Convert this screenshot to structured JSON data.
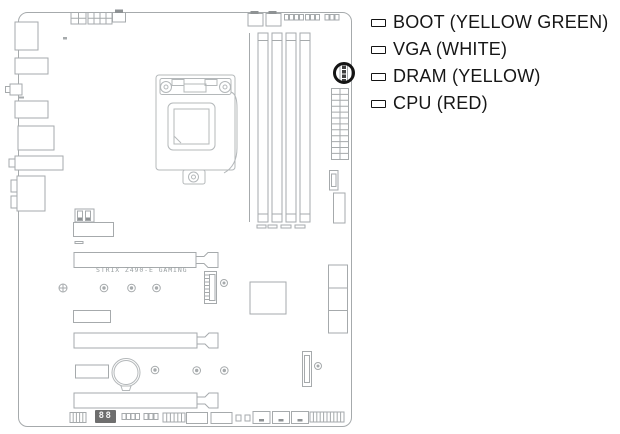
{
  "figure": {
    "type": "motherboard-qled-location-diagram",
    "highlight": "q-led-cluster-circled"
  },
  "legend": {
    "items": [
      {
        "id": "boot",
        "label": "BOOT (YELLOW GREEN)"
      },
      {
        "id": "vga",
        "label": "VGA (WHITE)"
      },
      {
        "id": "dram",
        "label": "DRAM (YELLOW)"
      },
      {
        "id": "cpu",
        "label": "CPU (RED)"
      }
    ]
  },
  "board": {
    "model_text": "STRIX Z490-E GAMING",
    "qcode_display": "88"
  },
  "icons": {
    "legend_marker": "led-rectangle-outline-icon",
    "qled_location_marker": "black-circle-highlight-icon"
  },
  "colors": {
    "line_gray": "#a6aaac",
    "socket_gray": "#b4b8ba",
    "highlight_black": "#141414",
    "qcode_background": "#6e6e6e",
    "qcode_digits": "#f4f4f4",
    "text_black": "#161616"
  }
}
